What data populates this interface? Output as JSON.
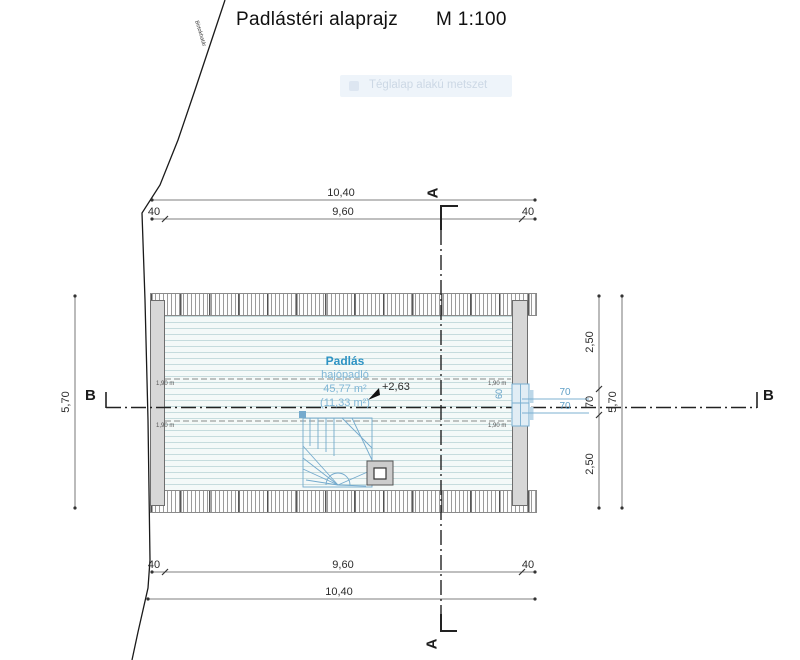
{
  "title": {
    "text": "Padlástéri alaprajz",
    "scale": "M 1:100"
  },
  "overlay_tooltip": {
    "label": "Téglalap alakú metszet"
  },
  "boundary_label": "Birtokhatár",
  "section_markers": {
    "a": "A",
    "b": "B"
  },
  "dims": {
    "overall_h": "10,40",
    "inner_h": "9,60",
    "side_offset": "40",
    "overall_v": "5,70",
    "right_upper": "2,50",
    "right_mid": "70",
    "right_lower": "2,50",
    "window_w": "70",
    "window_h": "60",
    "headroom": "1,90 m"
  },
  "room": {
    "name": "Padlás",
    "floor_type": "hajópadló",
    "area": "45,77 m²",
    "area_secondary": "(11,33 m²)",
    "level": "+2,63"
  },
  "colors": {
    "room_label": "#2d93c4",
    "room_sub": "#7fb6d6",
    "blue_dim": "#6fa7cc",
    "wall_fill": "#d7d7d7"
  }
}
